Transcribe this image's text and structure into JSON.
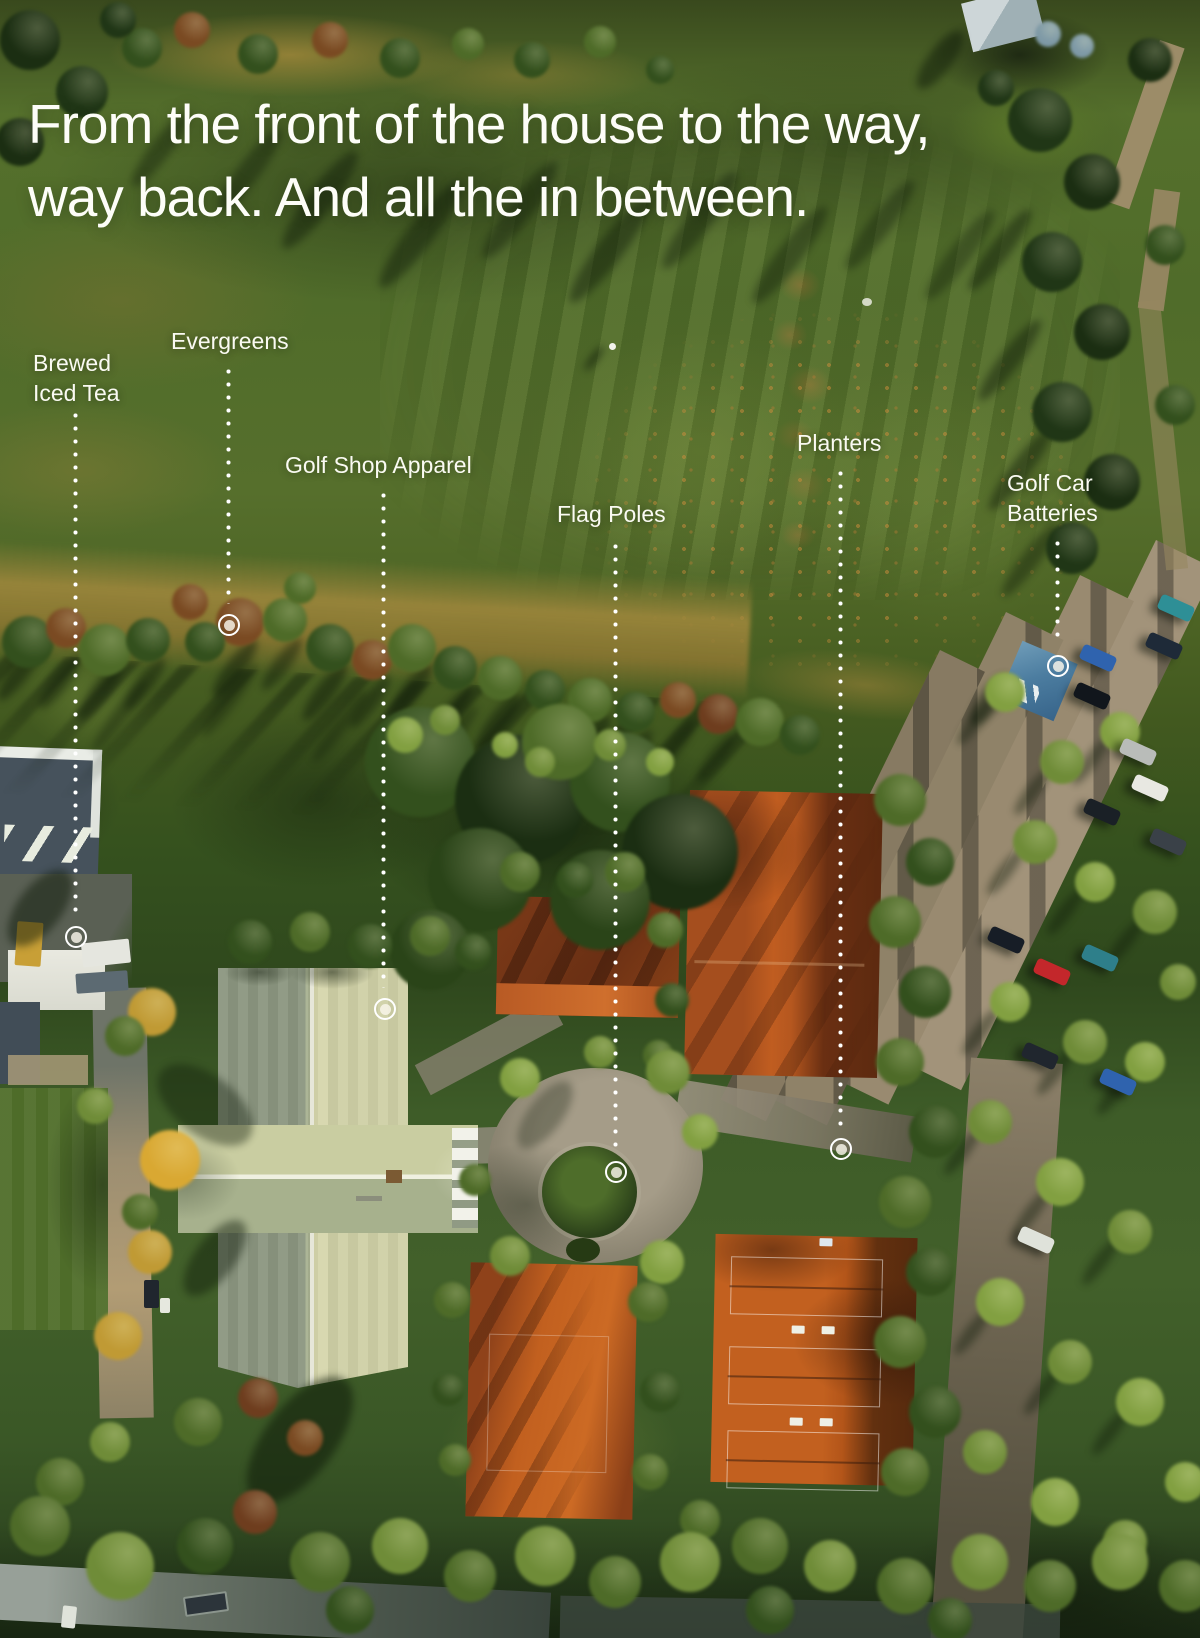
{
  "headline": {
    "line1": "From the front of the house to the way,",
    "line2": "way back. And all the in between."
  },
  "callouts": [
    {
      "id": "brewed-iced-tea",
      "lines": [
        "Brewed",
        "Iced Tea"
      ]
    },
    {
      "id": "evergreens",
      "lines": [
        "Evergreens"
      ]
    },
    {
      "id": "golf-shop-apparel",
      "lines": [
        "Golf Shop Apparel"
      ]
    },
    {
      "id": "flag-poles",
      "lines": [
        "Flag Poles"
      ]
    },
    {
      "id": "planters",
      "lines": [
        "Planters"
      ]
    },
    {
      "id": "golf-car-batteries",
      "lines": [
        "Golf Car",
        "Batteries"
      ]
    }
  ],
  "colors": {
    "label_text": "#ffffff",
    "marker": "#ffffff",
    "clay_court": "#c2601f",
    "fairway_green": "#55702c",
    "roof_sage": "#cfd0a6"
  }
}
